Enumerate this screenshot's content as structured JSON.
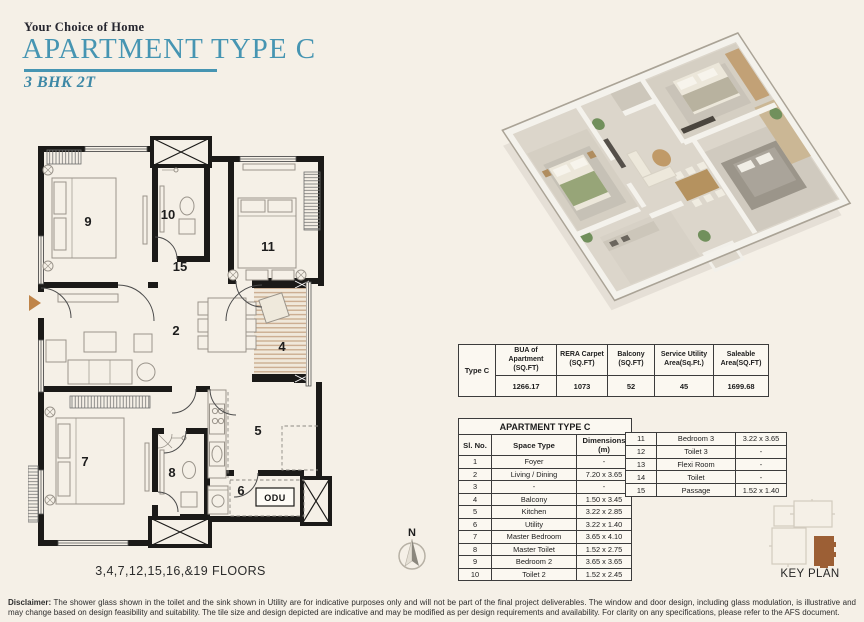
{
  "header": {
    "eyebrow": "Your Choice of Home",
    "title": "APARTMENT TYPE C",
    "subtitle": "3 BHK 2T",
    "accent_color": "#4695b2"
  },
  "floorplan": {
    "room_labels": [
      "9",
      "10",
      "11",
      "15",
      "2",
      "4",
      "5",
      "6",
      "7",
      "8"
    ],
    "odu_label": "ODU",
    "compass_label": "N",
    "floors_note": "3,4,7,12,15,16,&19 FLOORS"
  },
  "spec_table": {
    "type_label": "Type C",
    "columns": [
      {
        "label": "BUA of Apartment (SQ.FT)",
        "value": "1266.17"
      },
      {
        "label": "RERA Carpet (SQ.FT)",
        "value": "1073"
      },
      {
        "label": "Balcony (SQ.FT)",
        "value": "52"
      },
      {
        "label": "Service Utility Area(Sq.Ft.)",
        "value": "45"
      },
      {
        "label": "Saleable Area(SQ.FT)",
        "value": "1699.68"
      }
    ]
  },
  "room_table": {
    "title": "APARTMENT TYPE C",
    "headers": [
      "Sl. No.",
      "Space Type",
      "Dimensions (m)"
    ],
    "rows": [
      [
        "1",
        "Foyer",
        "-"
      ],
      [
        "2",
        "Living / Dining",
        "7.20 x 3.65"
      ],
      [
        "3",
        "-",
        "-"
      ],
      [
        "4",
        "Balcony",
        "1.50 x 3.45"
      ],
      [
        "5",
        "Kitchen",
        "3.22 x 2.85"
      ],
      [
        "6",
        "Utility",
        "3.22 x 1.40"
      ],
      [
        "7",
        "Master Bedroom",
        "3.65 x 4.10"
      ],
      [
        "8",
        "Master Toilet",
        "1.52 x 2.75"
      ],
      [
        "9",
        "Bedroom 2",
        "3.65 x 3.65"
      ],
      [
        "10",
        "Toilet 2",
        "1.52 x 2.45"
      ]
    ]
  },
  "room_table2": {
    "rows": [
      [
        "11",
        "Bedroom 3",
        "3.22 x 3.65"
      ],
      [
        "12",
        "Toilet 3",
        "-"
      ],
      [
        "13",
        "Flexi Room",
        "-"
      ],
      [
        "14",
        "Toilet",
        "-"
      ],
      [
        "15",
        "Passage",
        "1.52 x 1.40"
      ]
    ]
  },
  "key_plan": {
    "label": "KEY PLAN",
    "highlight_color": "#9c5f35"
  },
  "disclaimer": {
    "label": "Disclaimer:",
    "text": " The shower glass shown in the toilet and the sink shown in Utility are for indicative purposes only and will not be part of the final project deliverables. The window and door design, including glass modulation, is illustrative and may change based on design feasibility and suitability. The tile size and design depicted are indicative and may be modified as per design requirements and availability. For clarity on any specifications, please refer to the AFS document."
  }
}
